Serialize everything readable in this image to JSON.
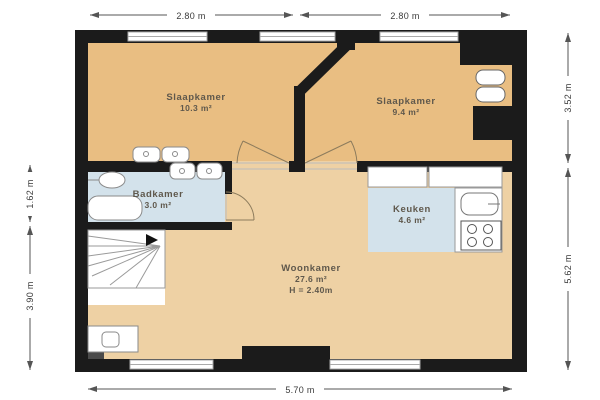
{
  "colors": {
    "wall": "#1b1b1b",
    "floor_bedroom": "#e9be82",
    "floor_living": "#eed1a4",
    "wet_room": "#d3e2eb",
    "fixture_stroke": "#8a8a8a",
    "stair_line": "#9a9a9a",
    "door_arc": "#8c7b5c",
    "dimension_line": "#555555",
    "dimension_text": "#3a3a3a",
    "label_text": "#5f584c"
  },
  "rooms": {
    "slaapkamer1": {
      "name": "Slaapkamer",
      "area": "10.3 m²"
    },
    "slaapkamer2": {
      "name": "Slaapkamer",
      "area": "9.4 m²"
    },
    "badkamer": {
      "name": "Badkamer",
      "area": "3.0 m²"
    },
    "keuken": {
      "name": "Keuken",
      "area": "4.6 m²"
    },
    "woonkamer": {
      "name": "Woonkamer",
      "area": "27.6 m²",
      "ceiling_height": "H = 2.40m"
    }
  },
  "dimensions": {
    "top_left": "2.80 m",
    "top_right": "2.80 m",
    "left_upper": "1.62 m",
    "left_lower": "3.90 m",
    "right_upper": "3.52 m",
    "right_lower": "5.62 m",
    "bottom": "5.70 m"
  }
}
